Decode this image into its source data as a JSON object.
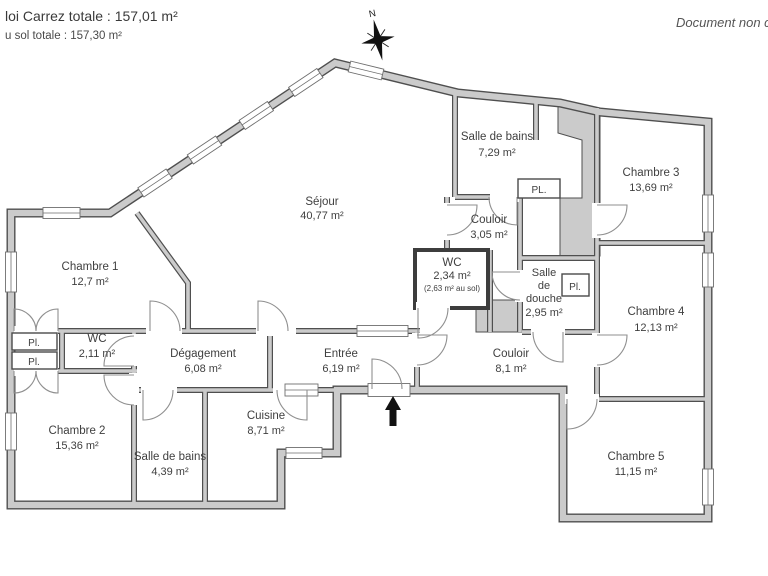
{
  "header": {
    "carrez_line": "loi Carrez totale :  157,01 m²",
    "floor_line": "u sol totale :  157,30 m²",
    "note_right": "Document non co"
  },
  "compass": {
    "north_label": "N"
  },
  "rooms": {
    "sejour": {
      "name": "Séjour",
      "area": "40,77 m²"
    },
    "chambre1": {
      "name": "Chambre 1",
      "area": "12,7 m²"
    },
    "chambre2": {
      "name": "Chambre 2",
      "area": "15,36 m²"
    },
    "chambre3": {
      "name": "Chambre 3",
      "area": "13,69 m²"
    },
    "chambre4": {
      "name": "Chambre 4",
      "area": "12,13 m²"
    },
    "chambre5": {
      "name": "Chambre 5",
      "area": "11,15 m²"
    },
    "salle_de_bains_haut": {
      "name": "Salle de bains",
      "area": "7,29 m²"
    },
    "salle_de_bains_bas": {
      "name": "Salle de bains",
      "area": "4,39 m²"
    },
    "salle_de_douche": {
      "line1": "Salle",
      "line2": "de",
      "line3": "douche",
      "area": "2,95 m²"
    },
    "wc_milieu": {
      "name": "WC",
      "area": "2,34 m²",
      "area_sol": "(2,63 m² au sol)"
    },
    "wc_gauche": {
      "name": "WC",
      "area": "2,11 m²"
    },
    "couloir_haut": {
      "name": "Couloir",
      "area": "3,05 m²"
    },
    "couloir_bas": {
      "name": "Couloir",
      "area": "8,1 m²"
    },
    "entree": {
      "name": "Entrée",
      "area": "6,19 m²"
    },
    "degagement": {
      "name": "Dégagement",
      "area": "6,08 m²"
    },
    "cuisine": {
      "name": "Cuisine",
      "area": "8,71 m²"
    }
  },
  "closets": {
    "pl_sdb": "PL.",
    "pl_gauche_haut": "Pl.",
    "pl_gauche_bas": "Pl.",
    "pl_douche": "Pl."
  },
  "colors": {
    "background": "#ffffff",
    "wall_fill": "#cbcbcb",
    "wall_outline": "#4f4f4f",
    "text": "#3f3f3f"
  }
}
